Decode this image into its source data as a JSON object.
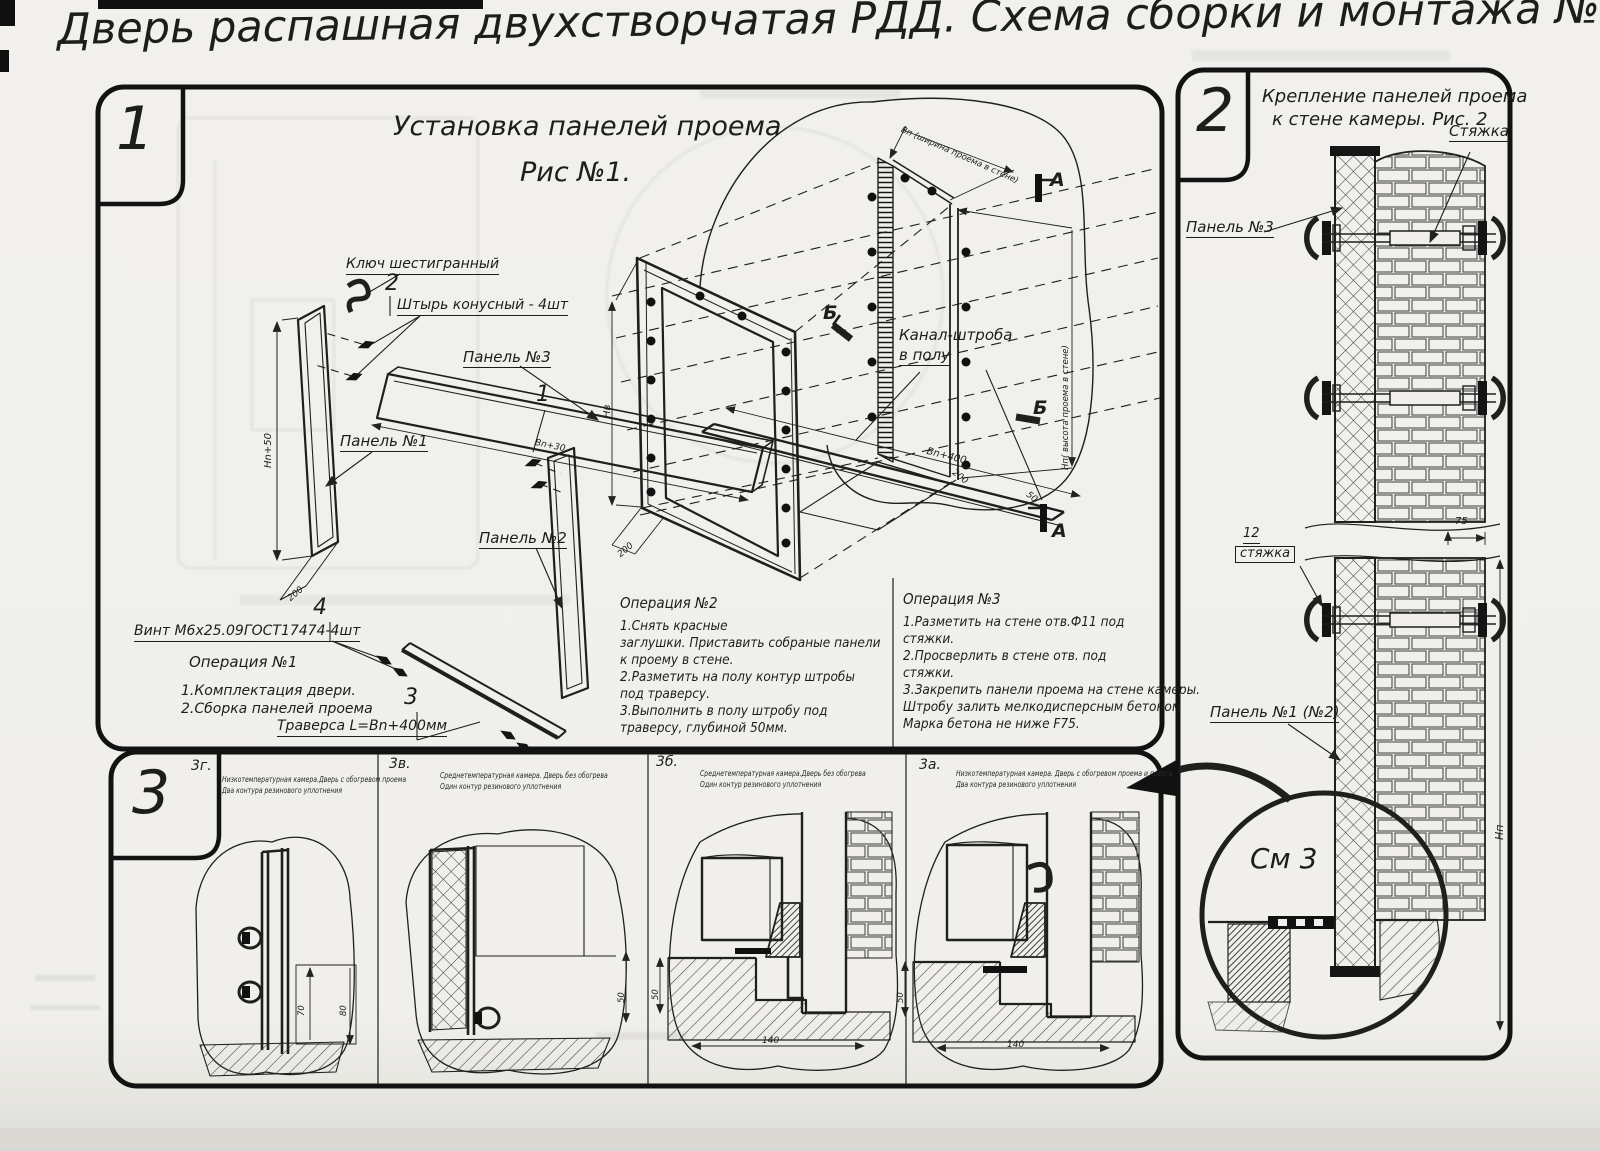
{
  "page": {
    "title": "Дверь распашная двухстворчатая РДД.  Схема сборки и монтажа №2"
  },
  "colors": {
    "ink": "#1d1d1b",
    "paper": "#f0efeb"
  },
  "s1": {
    "num": "1",
    "title1": "Установка панелей проема",
    "title2": "Рис №1.",
    "key": "Ключ шестигранный",
    "n2": "2",
    "pin": "Штырь конусный - 4шт",
    "panel3": "Панель №3",
    "panel1": "Панель №1",
    "n1": "1",
    "panel2": "Панель №2",
    "n4": "4",
    "screw": "Винт М6х25.09ГОСТ17474-4шт",
    "op1_title": "Операция №1",
    "op1_l1": "1.Комплектация двери.",
    "op1_l2": "2.Сборка панелей проема",
    "n3": "3",
    "traverse": "Траверса  L=Bn+400мм",
    "channel1": "Канал-штроба",
    "channel2": "в полу",
    "op2_title": "Операция №2",
    "op2": [
      "1.Снять красные",
      "заглушки. Приставить собраные панели",
      "к проему в стене.",
      "2.Разметить на полу контур штробы",
      "под траверсу.",
      "3.Выполнить в полу штробу под",
      "траверсу, глубиной 50мм."
    ],
    "op3_title": "Операция №3",
    "op3": [
      "1.Разметить на стене отв.Ф11 под",
      "стяжки.",
      "2.Просверлить в стене отв.  под",
      "стяжки.",
      "3.Закрепить панели проема на стене камеры.",
      "Штробу залить мелкодисперсным бетоном",
      "Марка бетона не ниже  F75."
    ],
    "markA": "А",
    "markB": "Б",
    "dims": {
      "hn50": "Hn+50",
      "d200": "200",
      "bn30": "Bn+30",
      "hv": "Нв",
      "d200b": "200",
      "bn400": "Bn+400",
      "d200c": "200",
      "d50": "50",
      "width_note": "Вп (ширина проема в стене)",
      "height_note": "Нп( высота проема в стене)"
    }
  },
  "s2": {
    "num": "2",
    "title1": "Крепление панелей проема",
    "title2": "к стене камеры. Рис. 2",
    "tie": "Стяжка",
    "panel3": "Панель №3",
    "n12": "12",
    "tie2": "стяжка",
    "panel12": "Панель №1 (№2)",
    "see": "См 3",
    "d75": "75",
    "hn": "Нп"
  },
  "s3": {
    "num": "3",
    "p": [
      {
        "l": "3г.",
        "c1": "Низкотемпературная камера.Дверь с обогревом проема",
        "c2": "Два контура резинового уплотнения",
        "d1": "70",
        "d2": "80"
      },
      {
        "l": "3в.",
        "c1": "Среднетемпературная камера. Дверь без обогрева",
        "c2": "Один контур резинового уплотнения",
        "d1": "50"
      },
      {
        "l": "3б.",
        "c1": "Среднетемпературная камера.Дверь без обогрева",
        "c2": "Один контур резинового уплотнения",
        "d1": "50",
        "d2": "140"
      },
      {
        "l": "3а.",
        "c1": "Низкотемпературная камера. Дверь с обогревом проема и порога",
        "c2": "Два контура резинового уплотнения",
        "d1": "50",
        "d2": "140"
      }
    ]
  }
}
